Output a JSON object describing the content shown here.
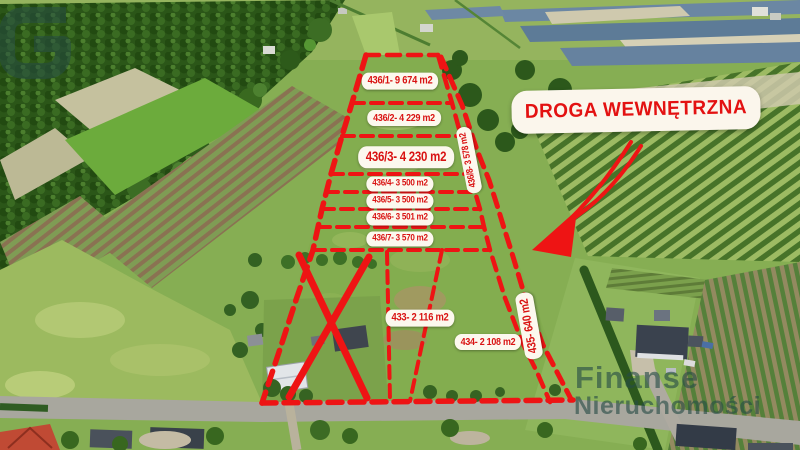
{
  "parcels": [
    {
      "id": "436/1",
      "label": "436/1- 9 674 m2"
    },
    {
      "id": "436/2",
      "label": "436/2- 4 229 m2"
    },
    {
      "id": "436/3",
      "label": "436/3- 4 230 m2"
    },
    {
      "id": "436/4",
      "label": "436/4- 3 500 m2"
    },
    {
      "id": "436/5",
      "label": "436/5- 3 500 m2"
    },
    {
      "id": "436/6",
      "label": "436/6- 3 501 m2"
    },
    {
      "id": "436/7",
      "label": "436/7- 3 570 m2"
    },
    {
      "id": "436/8",
      "label": "436/8- 3 578 m2"
    },
    {
      "id": "433",
      "label": "433- 2 116 m2"
    },
    {
      "id": "434",
      "label": "434-  2 108  m2"
    },
    {
      "id": "435",
      "label": "435- 640 m2"
    }
  ],
  "annotations": {
    "road_callout": "DROGA WEWNĘTRZNA"
  },
  "watermark": {
    "brand_line1": "Finanse",
    "brand_line2": "Nieruchomości"
  },
  "colors": {
    "overlay_red": "#ee1414",
    "label_text": "#d91212",
    "label_bg": "#fcf8ee",
    "watermark_teal": "#264c46"
  }
}
